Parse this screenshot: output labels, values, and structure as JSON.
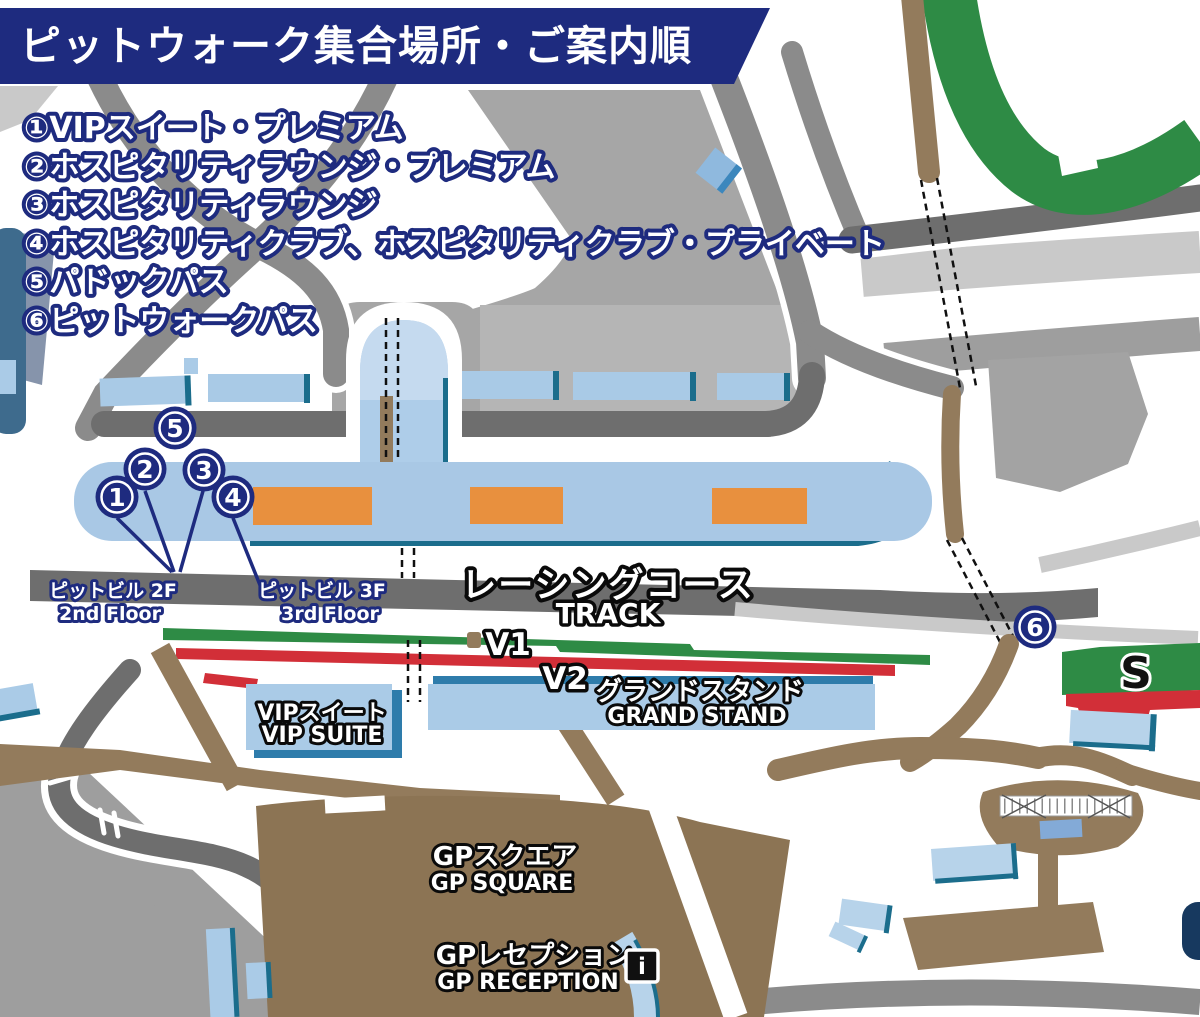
{
  "header": {
    "title": "ピットウォーク集合場所・ご案内順"
  },
  "legend": {
    "items": [
      "①VIPスイート・プレミアム",
      "②ホスピタリティラウンジ・プレミアム",
      "③ホスピタリティラウンジ",
      "④ホスピタリティクラブ、ホスピタリティクラブ・プライベート",
      "⑤パドックパス",
      "⑥ピットウォークパス"
    ]
  },
  "map": {
    "marker_numbers": {
      "m1": "1",
      "m2": "2",
      "m3": "3",
      "m4": "4",
      "m5": "5",
      "m6": "6"
    },
    "labels": {
      "pit_bldg_2f_jp": "ピットビル 2F",
      "pit_bldg_2f_en": "2nd Floor",
      "pit_bldg_3f_jp": "ピットビル 3F",
      "pit_bldg_3f_en": "3rd Floor",
      "track_jp": "レーシングコース",
      "track_en": "TRACK",
      "stand_v1": "V1",
      "stand_v2": "V2",
      "stand_s": "S",
      "vip_suite_jp": "VIPスイート",
      "vip_suite_en": "VIP SUITE",
      "grand_stand_jp": "グランドスタンド",
      "grand_stand_en": "GRAND STAND",
      "gp_square_jp": "GPスクエア",
      "gp_square_en": "GP SQUARE",
      "gp_reception_jp": "GPレセプション",
      "gp_reception_en": "GP RECEPTION",
      "info_icon": "i"
    },
    "colors": {
      "navy": "#1e2b7f",
      "road": "#8b8b8b",
      "road_dark": "#6e6e6e",
      "area_gray": "#a6a6a6",
      "area_light_gray": "#c9c9c9",
      "building_blue": "#a9c8e5",
      "teal_edge": "#1b6d8c",
      "steel_blue": "#2e7cab",
      "orange": "#e8903e",
      "green": "#2e8b45",
      "red": "#d22f38",
      "brown_path": "#937b5c",
      "brown_plaza": "#8c7454",
      "medium_blue": "#83aad7",
      "slate_blue": "#3e6b8d",
      "gray_blue": "#8694ab",
      "navy_dark": "#17395f"
    }
  }
}
